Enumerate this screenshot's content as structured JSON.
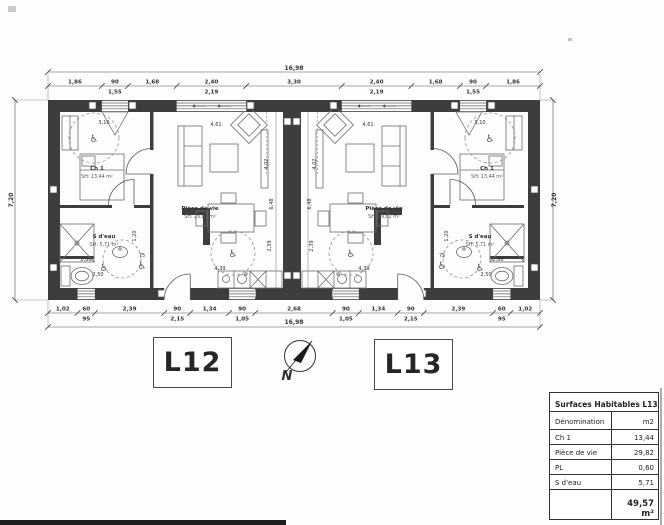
{
  "plan": {
    "overall_width_label": "16,98",
    "overall_height_label": "7,20",
    "dims_top": [
      {
        "v": 1.86,
        "l": "1,86"
      },
      {
        "v": 0.9,
        "l": "90",
        "s": "1,55"
      },
      {
        "v": 1.68,
        "l": "1,68"
      },
      {
        "v": 2.4,
        "l": "2,40",
        "s": "2,19"
      },
      {
        "v": 3.3,
        "l": "3,30"
      },
      {
        "v": 2.4,
        "l": "2,40",
        "s": "2,19"
      },
      {
        "v": 1.68,
        "l": "1,68"
      },
      {
        "v": 0.9,
        "l": "90",
        "s": "1,55"
      },
      {
        "v": 1.86,
        "l": "1,86"
      }
    ],
    "dims_bottom": [
      {
        "v": 1.02,
        "l": "1,02"
      },
      {
        "v": 0.6,
        "l": "60",
        "s": "95"
      },
      {
        "v": 2.39,
        "l": "2,39"
      },
      {
        "v": 0.9,
        "l": "90",
        "s": "2,15"
      },
      {
        "v": 1.34,
        "l": "1,34"
      },
      {
        "v": 0.9,
        "l": "90",
        "s": "1,05"
      },
      {
        "v": 2.68,
        "l": "2,68"
      },
      {
        "v": 0.9,
        "l": "90",
        "s": "1,05"
      },
      {
        "v": 1.34,
        "l": "1,34"
      },
      {
        "v": 0.9,
        "l": "90",
        "s": "2,15"
      },
      {
        "v": 2.39,
        "l": "2,39"
      },
      {
        "v": 0.6,
        "l": "60",
        "s": "95"
      },
      {
        "v": 1.02,
        "l": "1,02"
      }
    ]
  },
  "units": [
    {
      "id": "L12",
      "rooms": {
        "ch1": {
          "name": "Ch 1",
          "area": "SH: 13,44 m²"
        },
        "living": {
          "name": "Pièce de vie",
          "area": "SH: 29,82 m²"
        },
        "bath": {
          "name": "S d'eau",
          "area": "SH: 5,71 m²"
        }
      },
      "dims": [
        "3,10",
        "4,61",
        "4,02",
        "6,48",
        "2,39",
        "4,39",
        "2,86",
        "2,50",
        "1,20",
        "75"
      ]
    },
    {
      "id": "L13",
      "rooms": {
        "ch1": {
          "name": "Ch 1",
          "area": "SH: 13,44 m²"
        },
        "living": {
          "name": "Pièce de vie",
          "area": "SH: 29,82 m²"
        },
        "bath": {
          "name": "S d'eau",
          "area": "SH: 5,71 m²"
        }
      },
      "dims": [
        "3,10",
        "4,61",
        "4,02",
        "6,48",
        "2,39",
        "4,39",
        "2,86",
        "2,50",
        "1,20",
        "75"
      ]
    }
  ],
  "compass": {
    "north_label": "N"
  },
  "icons": {
    "wheelchair": "♿"
  },
  "table": {
    "title": "Surfaces Habitables L13",
    "col_name": "Dénomination",
    "col_unit": "m2",
    "rows": [
      {
        "name": "Ch 1",
        "value": "13,44"
      },
      {
        "name": "Pièce de vie",
        "value": "29,82"
      },
      {
        "name": "PL",
        "value": "0,60"
      },
      {
        "name": "S d'eau",
        "value": "5,71"
      }
    ],
    "total": "49,57 m²"
  },
  "colors": {
    "wall": "#3d3d3d",
    "line": "#6b6b6b",
    "dim": "#3a3a3a",
    "paper": "#fdfdfd"
  }
}
